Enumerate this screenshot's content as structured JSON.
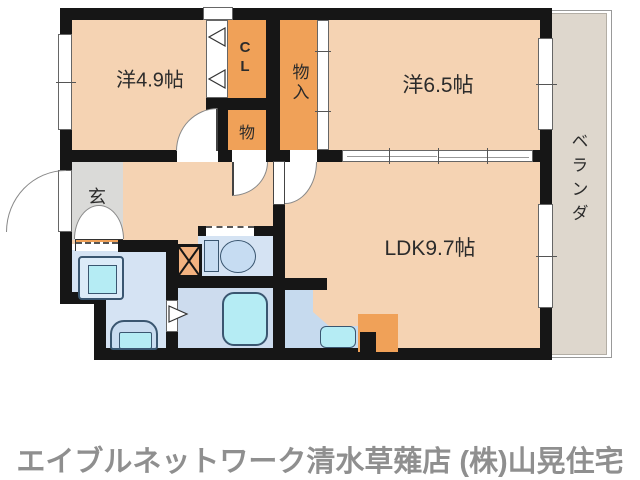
{
  "labels": {
    "room_49": "洋4.9帖",
    "closet_cl": "CL",
    "storage_small": "物",
    "storage_in": "物入",
    "room_65": "洋6.5帖",
    "ldk": "LDK9.7帖",
    "entrance": "玄",
    "veranda": "ベランダ"
  },
  "footer": {
    "agency": "エイブルネットワーク清水草薙店 (株)山晃住宅"
  },
  "colors": {
    "wall": "#161616",
    "peach": "#f5d3b3",
    "orange": "#f0a158",
    "orange_light": "#f2b280",
    "blue": "#d5e3f3",
    "blue2": "#cddcee",
    "blue3": "#c6daee",
    "cyan": "#b5ecf4",
    "genkan": "#dadad8",
    "veranda": "#ded7cd",
    "footergray": "#8f8f8f"
  }
}
